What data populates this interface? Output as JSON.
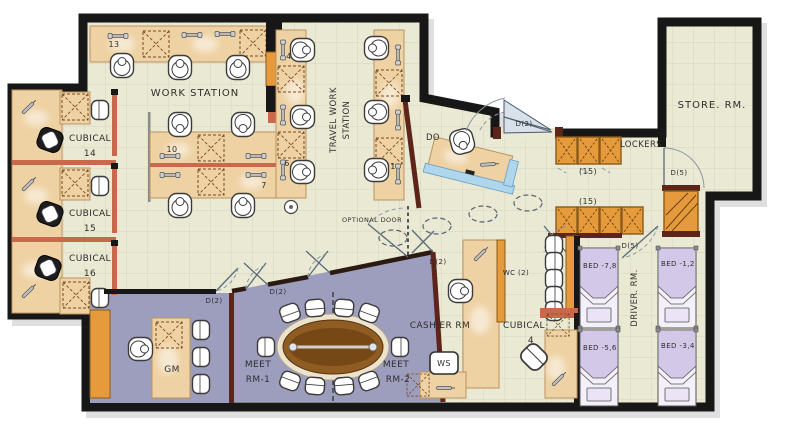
{
  "colors": {
    "canvas": "#ffffff",
    "floor": "#eae9d3",
    "grid": "#d6d5bb",
    "wall": "#171717",
    "desk": "#eed2a4",
    "desk_edge": "#bb9260",
    "cabinet": "#e59b3c",
    "partition": "#c8694b",
    "jamb": "#5c241a",
    "meeting": "#9d9dbe",
    "bed": "#d3c8e8",
    "bed_sheet": "#f3f0fa",
    "table": "#8f5c22",
    "reception_blue": "#aed7ee"
  },
  "rooms": {
    "work_station": "WORK STATION",
    "travel_work_station": {
      "line1": "TRAVEL WORK",
      "line2": "STATION"
    },
    "store": "STORE. RM.",
    "do": "DO",
    "cashier": "CASHIER RM",
    "gm": "GM",
    "driver": "DRIVER. RM.",
    "wc": "WC (2)",
    "meet1": {
      "line1": "MEET",
      "line2": "RM-1"
    },
    "meet2": {
      "line1": "MEET",
      "line2": "RM-2"
    },
    "cubical14": {
      "word": "CUBICAL",
      "num": "14"
    },
    "cubical15": {
      "word": "CUBICAL",
      "num": "15"
    },
    "cubical16": {
      "word": "CUBICAL",
      "num": "16"
    },
    "cubical4": {
      "word": "CUBICAL",
      "num": "4"
    }
  },
  "storage": {
    "lockers": "LOCKERS",
    "locker_capacity": "(15)"
  },
  "beds": {
    "b78": "BED -7,8",
    "b56": "BED -5,6",
    "b12": "BED -1,2",
    "b34": "BED -3,4"
  },
  "doors": {
    "d2": "D(2)",
    "d5": "D(5)",
    "optional": "OPTIONAL DOOR"
  },
  "workstation_numbers": {
    "n13": "13",
    "n10": "10",
    "n7": "7",
    "n4": "4",
    "n6": "6",
    "n1": "1"
  },
  "annotations": {
    "ws": "WS"
  }
}
